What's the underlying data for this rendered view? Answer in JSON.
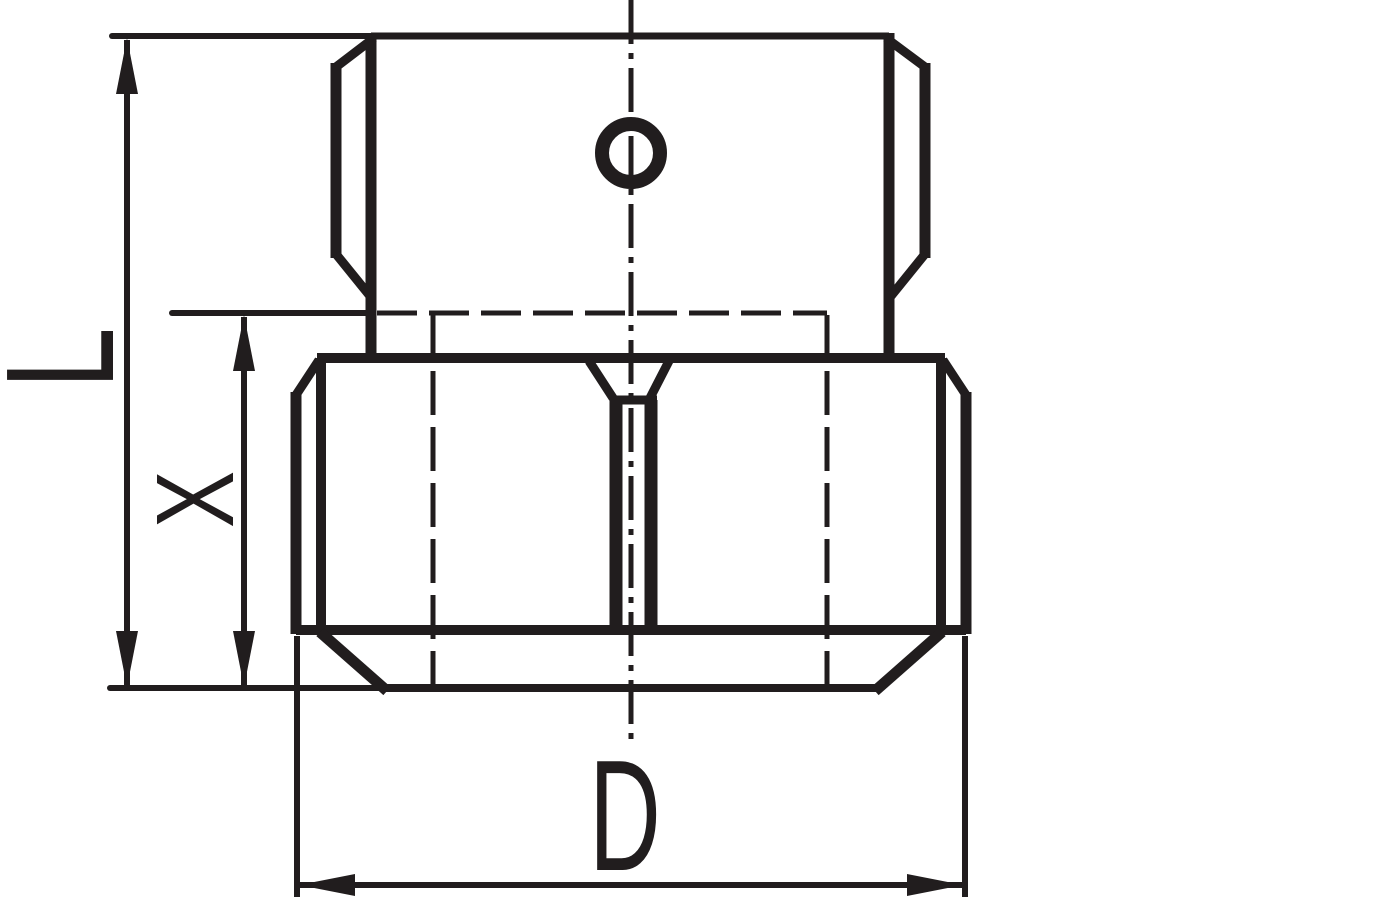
{
  "labels": {
    "l": "L",
    "x": "X",
    "d": "D"
  },
  "colors": {
    "ink": "#211d1e",
    "background": "#ffffff"
  }
}
